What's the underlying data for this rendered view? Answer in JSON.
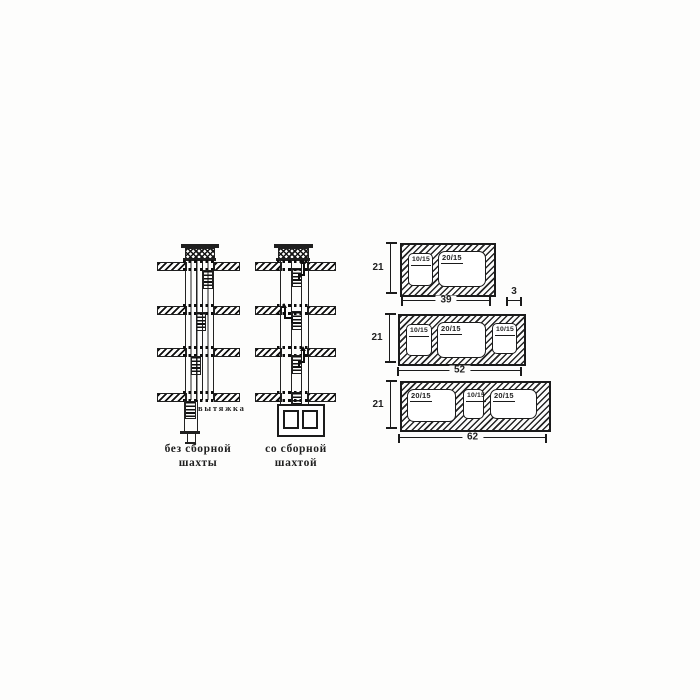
{
  "diagrams": {
    "left": {
      "caption_line1": "без сборной",
      "caption_line2": "шахты",
      "exhaust_label": "вытяжка"
    },
    "right": {
      "caption_line1": "со сборной",
      "caption_line2": "шахтой"
    }
  },
  "blocks": [
    {
      "height_label": "21",
      "width_label": "39",
      "wall_label": "3",
      "openings": [
        "10/15",
        "20/15"
      ]
    },
    {
      "height_label": "21",
      "width_label": "52",
      "openings": [
        "10/15",
        "20/15",
        "10/15"
      ]
    },
    {
      "height_label": "21",
      "width_label": "62",
      "openings": [
        "20/15",
        "10/15",
        "20/15"
      ]
    }
  ],
  "colors": {
    "ink": "#1f1f1f",
    "paper": "#fdfdfc"
  }
}
